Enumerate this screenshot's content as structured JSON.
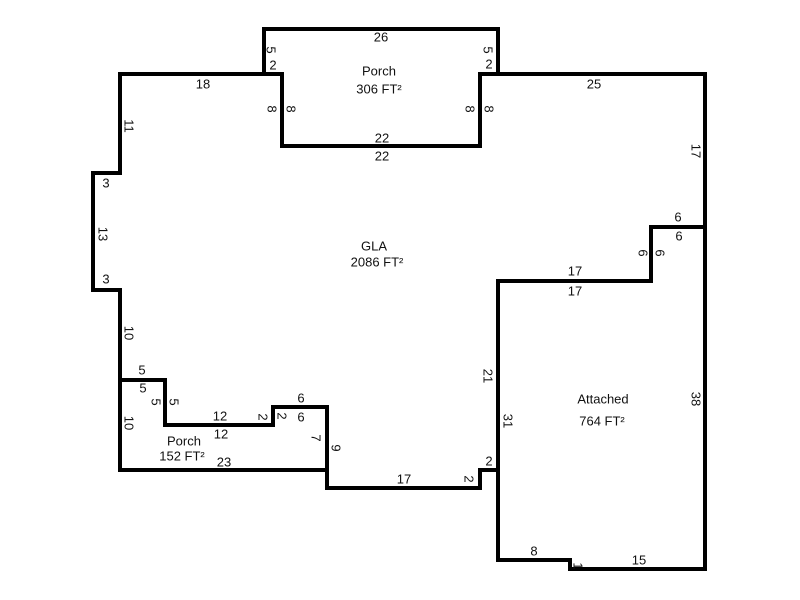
{
  "page": {
    "background": "#ffffff",
    "width": 800,
    "height": 600
  },
  "sketch": {
    "wall_color": "#000000",
    "wall_thickness": 4,
    "label_color": "#111111",
    "scale_px_per_ft": 9,
    "areas": [
      {
        "id": "porch-top",
        "name": "Porch",
        "size": "306 FT²",
        "name_pos": [
          379,
          71
        ],
        "size_pos": [
          379,
          89
        ],
        "polygon": [
          [
            264,
            29
          ],
          [
            498,
            29
          ],
          [
            498,
            74
          ],
          [
            480,
            74
          ],
          [
            480,
            146
          ],
          [
            282,
            146
          ],
          [
            282,
            74
          ],
          [
            264,
            74
          ]
        ]
      },
      {
        "id": "gla",
        "name": "GLA",
        "size": "2086 FT²",
        "name_pos": [
          374,
          246
        ],
        "size_pos": [
          377,
          262
        ],
        "polygon": [
          [
            120,
            74
          ],
          [
            282,
            74
          ],
          [
            282,
            146
          ],
          [
            480,
            146
          ],
          [
            480,
            74
          ],
          [
            705,
            74
          ],
          [
            705,
            227
          ],
          [
            651,
            227
          ],
          [
            651,
            281
          ],
          [
            498,
            281
          ],
          [
            498,
            470
          ],
          [
            480,
            470
          ],
          [
            480,
            488
          ],
          [
            327,
            488
          ],
          [
            327,
            407
          ],
          [
            273,
            407
          ],
          [
            273,
            425
          ],
          [
            165,
            425
          ],
          [
            165,
            380
          ],
          [
            120,
            380
          ],
          [
            120,
            290
          ],
          [
            93,
            290
          ],
          [
            93,
            173
          ],
          [
            120,
            173
          ]
        ]
      },
      {
        "id": "porch-bottom",
        "name": "Porch",
        "size": "152 FT²",
        "name_pos": [
          184,
          441
        ],
        "size_pos": [
          182,
          456
        ],
        "polygon": [
          [
            120,
            380
          ],
          [
            165,
            380
          ],
          [
            165,
            425
          ],
          [
            273,
            425
          ],
          [
            273,
            407
          ],
          [
            327,
            407
          ],
          [
            327,
            470
          ],
          [
            120,
            470
          ]
        ]
      },
      {
        "id": "attached-garage",
        "name": "Attached",
        "size": "764 FT²",
        "name_pos": [
          603,
          399
        ],
        "size_pos": [
          602,
          421
        ],
        "polygon": [
          [
            498,
            281
          ],
          [
            651,
            281
          ],
          [
            651,
            227
          ],
          [
            705,
            227
          ],
          [
            705,
            569
          ],
          [
            570,
            569
          ],
          [
            570,
            560
          ],
          [
            498,
            560
          ]
        ]
      }
    ],
    "dimensions": [
      {
        "t": "26",
        "x": 381,
        "y": 37,
        "o": "h"
      },
      {
        "t": "5",
        "x": 271,
        "y": 50,
        "o": "v"
      },
      {
        "t": "2",
        "x": 273,
        "y": 65,
        "o": "h"
      },
      {
        "t": "5",
        "x": 488,
        "y": 50,
        "o": "v"
      },
      {
        "t": "2",
        "x": 489,
        "y": 64,
        "o": "h"
      },
      {
        "t": "8",
        "x": 272,
        "y": 109,
        "o": "v"
      },
      {
        "t": "8",
        "x": 291,
        "y": 109,
        "o": "v"
      },
      {
        "t": "8",
        "x": 470,
        "y": 109,
        "o": "v"
      },
      {
        "t": "8",
        "x": 489,
        "y": 109,
        "o": "v"
      },
      {
        "t": "22",
        "x": 382,
        "y": 138,
        "o": "h"
      },
      {
        "t": "22",
        "x": 382,
        "y": 156,
        "o": "h"
      },
      {
        "t": "18",
        "x": 203,
        "y": 84,
        "o": "h"
      },
      {
        "t": "25",
        "x": 594,
        "y": 84,
        "o": "h"
      },
      {
        "t": "17",
        "x": 696,
        "y": 151,
        "o": "v"
      },
      {
        "t": "11",
        "x": 129,
        "y": 126,
        "o": "v"
      },
      {
        "t": "3",
        "x": 106,
        "y": 183,
        "o": "h"
      },
      {
        "t": "13",
        "x": 103,
        "y": 234,
        "o": "v"
      },
      {
        "t": "3",
        "x": 106,
        "y": 279,
        "o": "h"
      },
      {
        "t": "10",
        "x": 129,
        "y": 333,
        "o": "v"
      },
      {
        "t": "5",
        "x": 142,
        "y": 370,
        "o": "h"
      },
      {
        "t": "5",
        "x": 143,
        "y": 388,
        "o": "h"
      },
      {
        "t": "5",
        "x": 156,
        "y": 402,
        "o": "v"
      },
      {
        "t": "5",
        "x": 174,
        "y": 402,
        "o": "v"
      },
      {
        "t": "10",
        "x": 129,
        "y": 423,
        "o": "v"
      },
      {
        "t": "12",
        "x": 220,
        "y": 416,
        "o": "h"
      },
      {
        "t": "12",
        "x": 221,
        "y": 434,
        "o": "h"
      },
      {
        "t": "2",
        "x": 263,
        "y": 417,
        "o": "v"
      },
      {
        "t": "2",
        "x": 282,
        "y": 416,
        "o": "v"
      },
      {
        "t": "6",
        "x": 301,
        "y": 398,
        "o": "h"
      },
      {
        "t": "6",
        "x": 301,
        "y": 417,
        "o": "h"
      },
      {
        "t": "7",
        "x": 316,
        "y": 438,
        "o": "v"
      },
      {
        "t": "9",
        "x": 336,
        "y": 448,
        "o": "v"
      },
      {
        "t": "23",
        "x": 224,
        "y": 462,
        "o": "h"
      },
      {
        "t": "17",
        "x": 404,
        "y": 479,
        "o": "h"
      },
      {
        "t": "2",
        "x": 469,
        "y": 479,
        "o": "v"
      },
      {
        "t": "2",
        "x": 489,
        "y": 461,
        "o": "h"
      },
      {
        "t": "21",
        "x": 488,
        "y": 376,
        "o": "v"
      },
      {
        "t": "31",
        "x": 508,
        "y": 421,
        "o": "v"
      },
      {
        "t": "6",
        "x": 678,
        "y": 217,
        "o": "h"
      },
      {
        "t": "6",
        "x": 679,
        "y": 236,
        "o": "h"
      },
      {
        "t": "6",
        "x": 643,
        "y": 253,
        "o": "v"
      },
      {
        "t": "6",
        "x": 660,
        "y": 253,
        "o": "v"
      },
      {
        "t": "17",
        "x": 575,
        "y": 271,
        "o": "h"
      },
      {
        "t": "17",
        "x": 575,
        "y": 291,
        "o": "h"
      },
      {
        "t": "38",
        "x": 696,
        "y": 399,
        "o": "v"
      },
      {
        "t": "8",
        "x": 534,
        "y": 551,
        "o": "h"
      },
      {
        "t": "1",
        "x": 578,
        "y": 566,
        "o": "v"
      },
      {
        "t": "15",
        "x": 639,
        "y": 560,
        "o": "h"
      }
    ]
  }
}
